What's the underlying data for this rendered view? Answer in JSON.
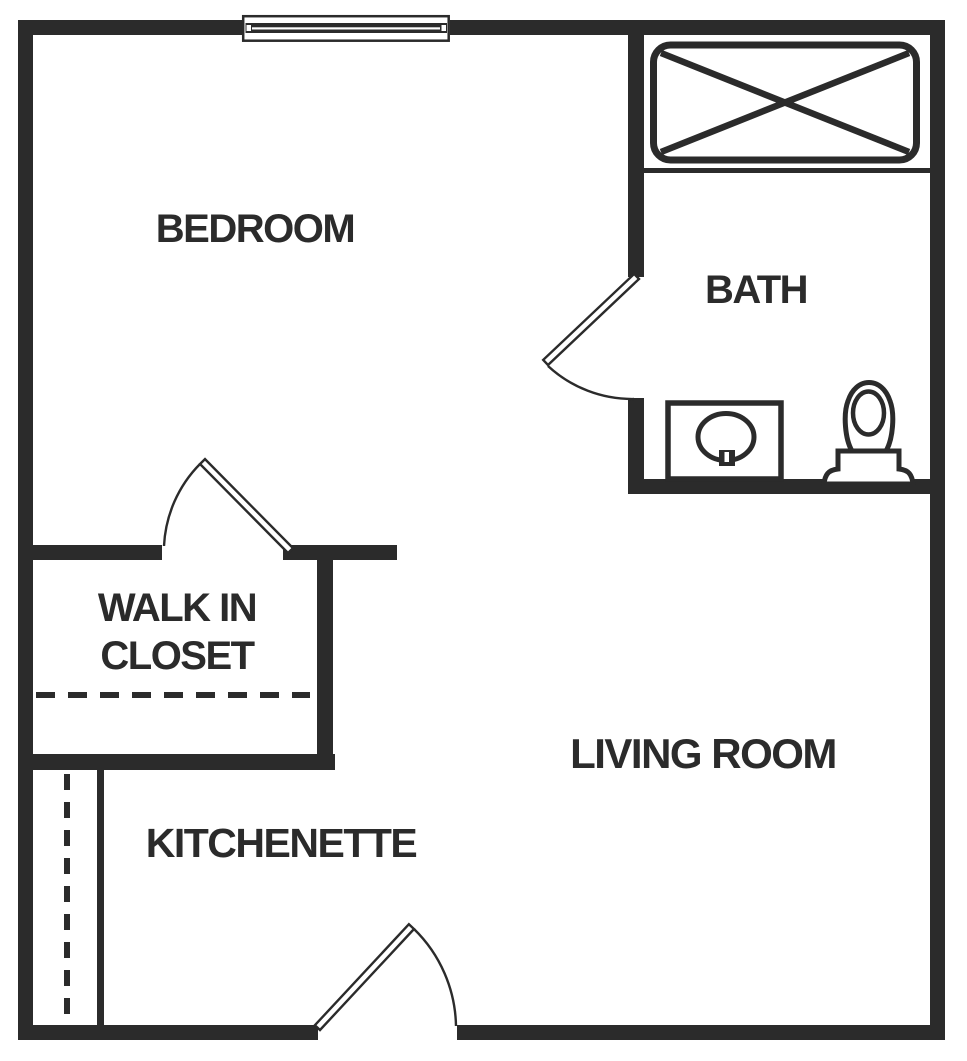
{
  "colors": {
    "wall": "#2b2b2b",
    "background": "#ffffff"
  },
  "rooms": {
    "bedroom": {
      "label": "BEDROOM"
    },
    "bath": {
      "label": "BATH"
    },
    "walk_in_closet": {
      "label_line1": "WALK IN",
      "label_line2": "CLOSET"
    },
    "living_room": {
      "label": "LIVING ROOM"
    },
    "kitchenette": {
      "label": "KITCHENETTE"
    }
  },
  "fixtures": {
    "window": "window-icon",
    "bathtub": "bathtub-icon",
    "sink": "sink-vanity-icon",
    "toilet": "toilet-icon",
    "doors": [
      "bath-door",
      "closet-door",
      "entry-door"
    ],
    "counter": "kitchenette-counter",
    "dashed_lines": [
      "closet-rod-dashed-line",
      "kitchenette-cabinet-dashed-line"
    ]
  }
}
